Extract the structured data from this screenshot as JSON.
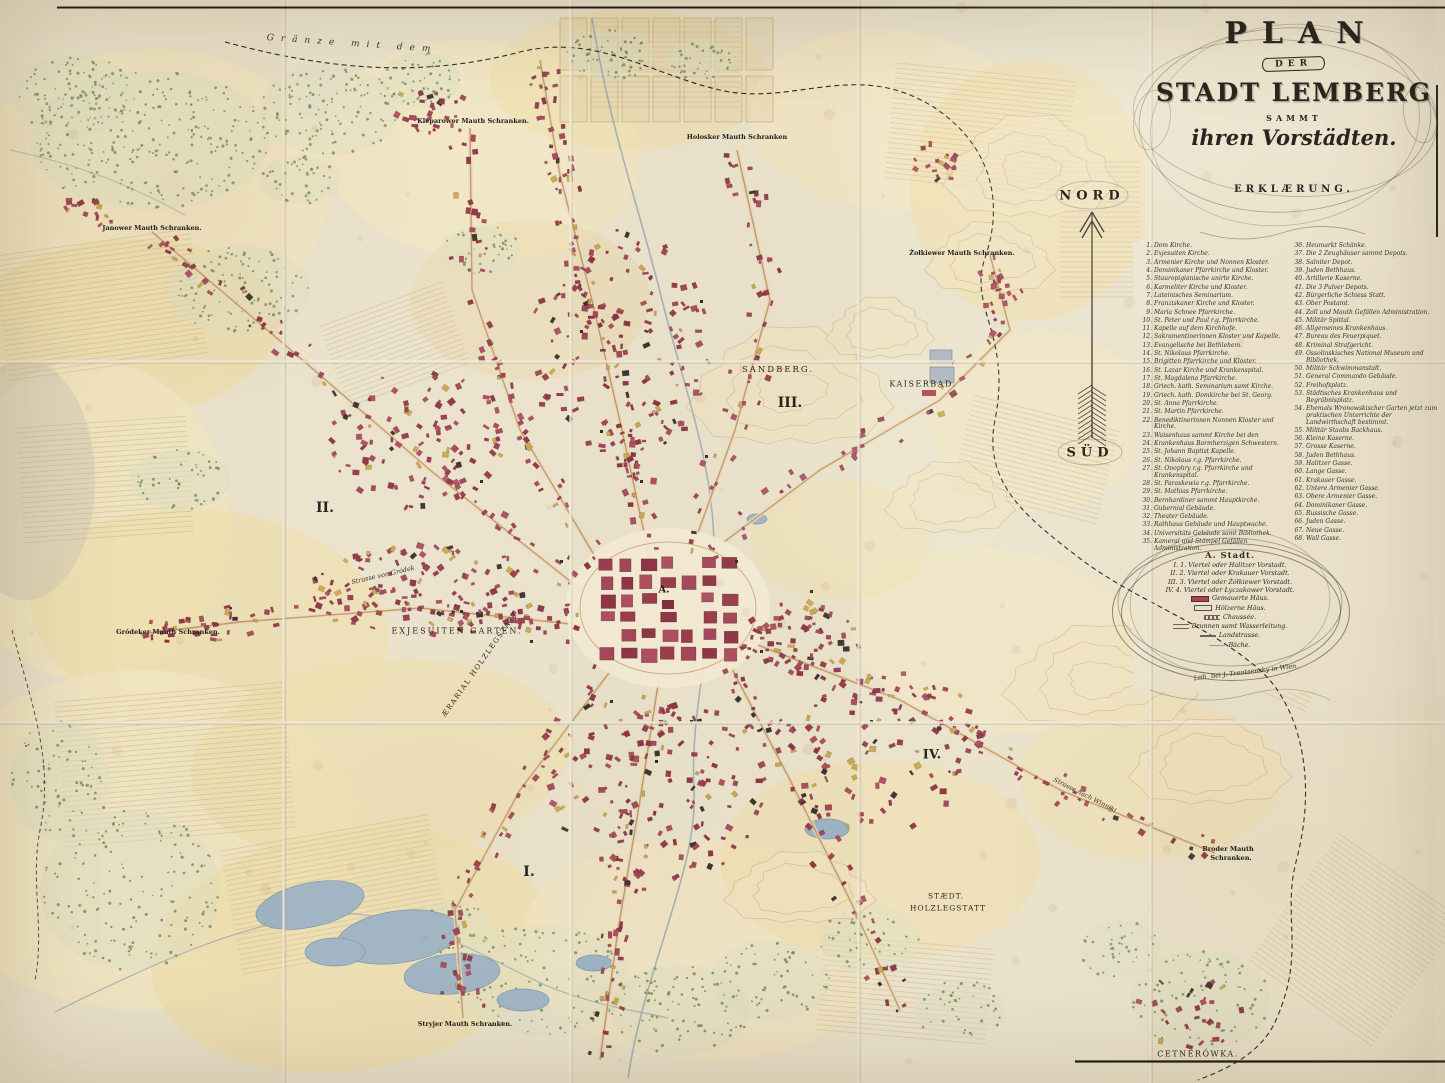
{
  "title_block": {
    "plan": "PLAN",
    "der": "DER",
    "stadt": "STADT LEMBERG",
    "sammt": "SAMMT",
    "vorstaedten": "ihren Vorstädten.",
    "erklaerung": "ERKLÆRUNG."
  },
  "compass": {
    "north": "NORD",
    "south": "SÜD"
  },
  "legend": {
    "left": [
      {
        "n": "1.",
        "t": "Dom Kirche."
      },
      {
        "n": "2.",
        "t": "Exjesuiten Kirche."
      },
      {
        "n": "3.",
        "t": "Armenier Kirche und Nonnen Kloster."
      },
      {
        "n": "4.",
        "t": "Dominikaner Pfarrkirche und Kloster."
      },
      {
        "n": "5.",
        "t": "Stauropigianische unirte Kirche."
      },
      {
        "n": "6.",
        "t": "Karmeliter Kirche und Kloster."
      },
      {
        "n": "7.",
        "t": "Lateinisches Seminarium."
      },
      {
        "n": "8.",
        "t": "Franziskaner Kirche und Kloster."
      },
      {
        "n": "9.",
        "t": "Maria Schnee Pfarrkirche."
      },
      {
        "n": "10.",
        "t": "St. Peter und Paul r.g. Pfarrkirche."
      },
      {
        "n": "11.",
        "t": "Kapelle auf dem Kirchhofe."
      },
      {
        "n": "12.",
        "t": "Sakramentinerinnen Kloster und Kapelle."
      },
      {
        "n": "13.",
        "t": "Evangelische bei Bethlehem."
      },
      {
        "n": "14.",
        "t": "St. Nikolaus Pfarrkirche."
      },
      {
        "n": "15.",
        "t": "Brigitten Pfarrkirche und Kloster."
      },
      {
        "n": "16.",
        "t": "St. Lazar Kirche und Krankenspital."
      },
      {
        "n": "17.",
        "t": "St. Magdalena Pfarrkirche."
      },
      {
        "n": "18.",
        "t": "Griech. kath. Seminarium samt Kirche."
      },
      {
        "n": "19.",
        "t": "Griech. kath. Domkirche bei St. Georg."
      },
      {
        "n": "20.",
        "t": "St. Anna Pfarrkirche."
      },
      {
        "n": "21.",
        "t": "St. Martin Pfarrkirche."
      },
      {
        "n": "22.",
        "t": "Benediktinerinnen Nonnen Kloster und Kirche."
      },
      {
        "n": "23.",
        "t": "Waisenhaus sammt Kirche bei den"
      },
      {
        "n": "24.",
        "t": "Krankenhaus Barmherzigen Schwestern."
      },
      {
        "n": "25.",
        "t": "St. Johann Baptist Kapelle."
      },
      {
        "n": "26.",
        "t": "St. Nikolaus r.g. Pfarrkirche."
      },
      {
        "n": "27.",
        "t": "St. Onophry r.g. Pfarrkirche und Krankenspital."
      },
      {
        "n": "28.",
        "t": "St. Paraskewia r.g. Pfarrkirche."
      },
      {
        "n": "29.",
        "t": "St. Mathias Pfarrkirche."
      },
      {
        "n": "30.",
        "t": "Bernhardiner sammt Hauptkirche."
      },
      {
        "n": "31.",
        "t": "Gubernial Gebäude."
      },
      {
        "n": "32.",
        "t": "Theater Gebäude."
      },
      {
        "n": "33.",
        "t": "Rathhaus Gebäude und Hauptwache."
      },
      {
        "n": "34.",
        "t": "Universitäts Gebäude samt Bibliothek."
      },
      {
        "n": "35.",
        "t": "Kameral und Stämpel Gefällen Administration."
      }
    ],
    "right": [
      {
        "n": "36.",
        "t": "Heumarkt Schänke."
      },
      {
        "n": "37.",
        "t": "Die 2 Zeughäuser sammt Depots."
      },
      {
        "n": "38.",
        "t": "Salniter Depot."
      },
      {
        "n": "39.",
        "t": "Juden Bethhaus."
      },
      {
        "n": "40.",
        "t": "Artillerie Kaserne."
      },
      {
        "n": "41.",
        "t": "Die 3 Pulver Depots."
      },
      {
        "n": "42.",
        "t": "Bürgerliche Schiess Statt."
      },
      {
        "n": "43.",
        "t": "Ober Postamt."
      },
      {
        "n": "44.",
        "t": "Zoll und Mauth Gefällen Administration."
      },
      {
        "n": "45.",
        "t": "Militär Spittal."
      },
      {
        "n": "46.",
        "t": "Allgemeines Krankenhaus."
      },
      {
        "n": "47.",
        "t": "Bureau des Feuerpiquet."
      },
      {
        "n": "48.",
        "t": "Kriminal Strafgericht."
      },
      {
        "n": "49.",
        "t": "Ossolinskisches National Museum und Bibliothek."
      },
      {
        "n": "50.",
        "t": "Militär Schwimmanstalt."
      },
      {
        "n": "51.",
        "t": "General Commando Gebäude."
      },
      {
        "n": "52.",
        "t": "Freihofsplatz."
      },
      {
        "n": "53.",
        "t": "Städtisches Krankenhaus und Begräbnisplatz."
      },
      {
        "n": "54.",
        "t": "Ehemals Wronowskischer Garten jetzt zum praktischen Unterrichte der Landwirthschaft bestimmt."
      },
      {
        "n": "55.",
        "t": "Militär Staabs Backhaus."
      },
      {
        "n": "56.",
        "t": "Kleine Kaserne."
      },
      {
        "n": "57.",
        "t": "Grosse Kaserne."
      },
      {
        "n": "58.",
        "t": "Juden Bethhaus."
      },
      {
        "n": "59.",
        "t": "Halitzer Gasse."
      },
      {
        "n": "60.",
        "t": "Lange Gasse."
      },
      {
        "n": "61.",
        "t": "Krakauer Gasse."
      },
      {
        "n": "62.",
        "t": "Untere Armenier Gasse."
      },
      {
        "n": "63.",
        "t": "Obere Armenier Gasse."
      },
      {
        "n": "64.",
        "t": "Dominikaner Gasse."
      },
      {
        "n": "65.",
        "t": "Russische Gasse."
      },
      {
        "n": "66.",
        "t": "Juden Gasse."
      },
      {
        "n": "67.",
        "t": "Neue Gasse."
      },
      {
        "n": "68.",
        "t": "Wall Gasse."
      }
    ]
  },
  "key": {
    "city": "A. Stadt.",
    "quarters": [
      "I. 1. Viertel oder Halitzer Vorstadt.",
      "II. 2. Viertel oder Krakauer Vorstadt.",
      "III. 3. Viertel oder Żółkiewer Vorstadt.",
      "IV. 4. Viertel oder Łyczakower Vorstadt."
    ],
    "symbols": [
      {
        "swatch": "masonry",
        "label": "Gemauerte Häus."
      },
      {
        "swatch": "wood",
        "label": "Hölzerne Häus."
      },
      {
        "swatch": "chaussee",
        "label": "Chaussée."
      },
      {
        "swatch": "brunnen",
        "label": "Brunnen samt Wasserleitung."
      },
      {
        "swatch": "land",
        "label": "Landstrasse."
      },
      {
        "swatch": "baeche",
        "label": "Bäche."
      }
    ],
    "credit": "Lith. bei J. Trentsensky in Wien."
  },
  "map_labels": [
    {
      "t": "Gränze mit dem",
      "x": 352,
      "y": 44,
      "st": "script",
      "s": 9,
      "r": 4,
      "ls": 7
    },
    {
      "t": "Kleparower Mauth Schranken.",
      "x": 473,
      "y": 121,
      "st": "mauth",
      "s": 6.5
    },
    {
      "t": "Holosker Mauth Schranken",
      "x": 737,
      "y": 137,
      "st": "mauth",
      "s": 6.5
    },
    {
      "t": "Żołkiewer Mauth Schranken.",
      "x": 962,
      "y": 253,
      "st": "mauth",
      "s": 6.5
    },
    {
      "t": "Janower Mauth Schranken.",
      "x": 152,
      "y": 228,
      "st": "mauth",
      "s": 6.5
    },
    {
      "t": "Gródeker Mauth Schranken.",
      "x": 168,
      "y": 632,
      "st": "mauth",
      "s": 6.5
    },
    {
      "t": "Stryjer Mauth Schranken.",
      "x": 465,
      "y": 1024,
      "st": "mauth",
      "s": 6.5
    },
    {
      "t": "Broder Mauth",
      "x": 1228,
      "y": 849,
      "st": "mauth",
      "s": 6.5
    },
    {
      "t": "Schranken.",
      "x": 1231,
      "y": 858,
      "st": "mauth",
      "s": 6.5
    },
    {
      "t": "SANDBERG.",
      "x": 778,
      "y": 370,
      "st": "caps",
      "s": 8.5,
      "ls": 2
    },
    {
      "t": "KAISERBAD.",
      "x": 923,
      "y": 384,
      "st": "caps",
      "s": 8,
      "ls": 1.5
    },
    {
      "t": "EXJESUITEN GARTEN.",
      "x": 457,
      "y": 631,
      "st": "caps",
      "s": 8,
      "ls": 2
    },
    {
      "t": "ÆRARIAL HOLZLEGSTATT",
      "x": 480,
      "y": 664,
      "st": "caps",
      "s": 7,
      "r": -55,
      "ls": 1.5
    },
    {
      "t": "STÆDT.",
      "x": 946,
      "y": 896,
      "st": "caps",
      "s": 7.5,
      "ls": 1
    },
    {
      "t": "HOLZLEGSTATT",
      "x": 948,
      "y": 908,
      "st": "caps",
      "s": 7.5,
      "ls": 1
    },
    {
      "t": "CETNERÓWKA.",
      "x": 1198,
      "y": 1054,
      "st": "caps",
      "s": 8,
      "ls": 1.5
    },
    {
      "t": "A.",
      "x": 664,
      "y": 590,
      "st": "roman",
      "s": 10
    },
    {
      "t": "I.",
      "x": 529,
      "y": 872,
      "st": "roman",
      "s": 14
    },
    {
      "t": "II.",
      "x": 325,
      "y": 508,
      "st": "roman",
      "s": 14
    },
    {
      "t": "III.",
      "x": 790,
      "y": 403,
      "st": "roman",
      "s": 14
    },
    {
      "t": "IV.",
      "x": 932,
      "y": 755,
      "st": "roman",
      "s": 13
    },
    {
      "t": "Strasse von Gródek",
      "x": 383,
      "y": 575,
      "st": "script",
      "s": 6.5,
      "r": -13
    },
    {
      "t": "Strasse nach Winniki",
      "x": 1085,
      "y": 795,
      "st": "script",
      "s": 6.5,
      "r": 27
    }
  ],
  "palette": {
    "paper": "#eae2cb",
    "field": "#efdfae",
    "building": "#a84353",
    "building_dark": "#8e3644",
    "forest": "#6e7f50",
    "water": "#9db4c6",
    "road": "#bf9a6e",
    "ink": "#2a2521",
    "gold": "#d9a833"
  }
}
